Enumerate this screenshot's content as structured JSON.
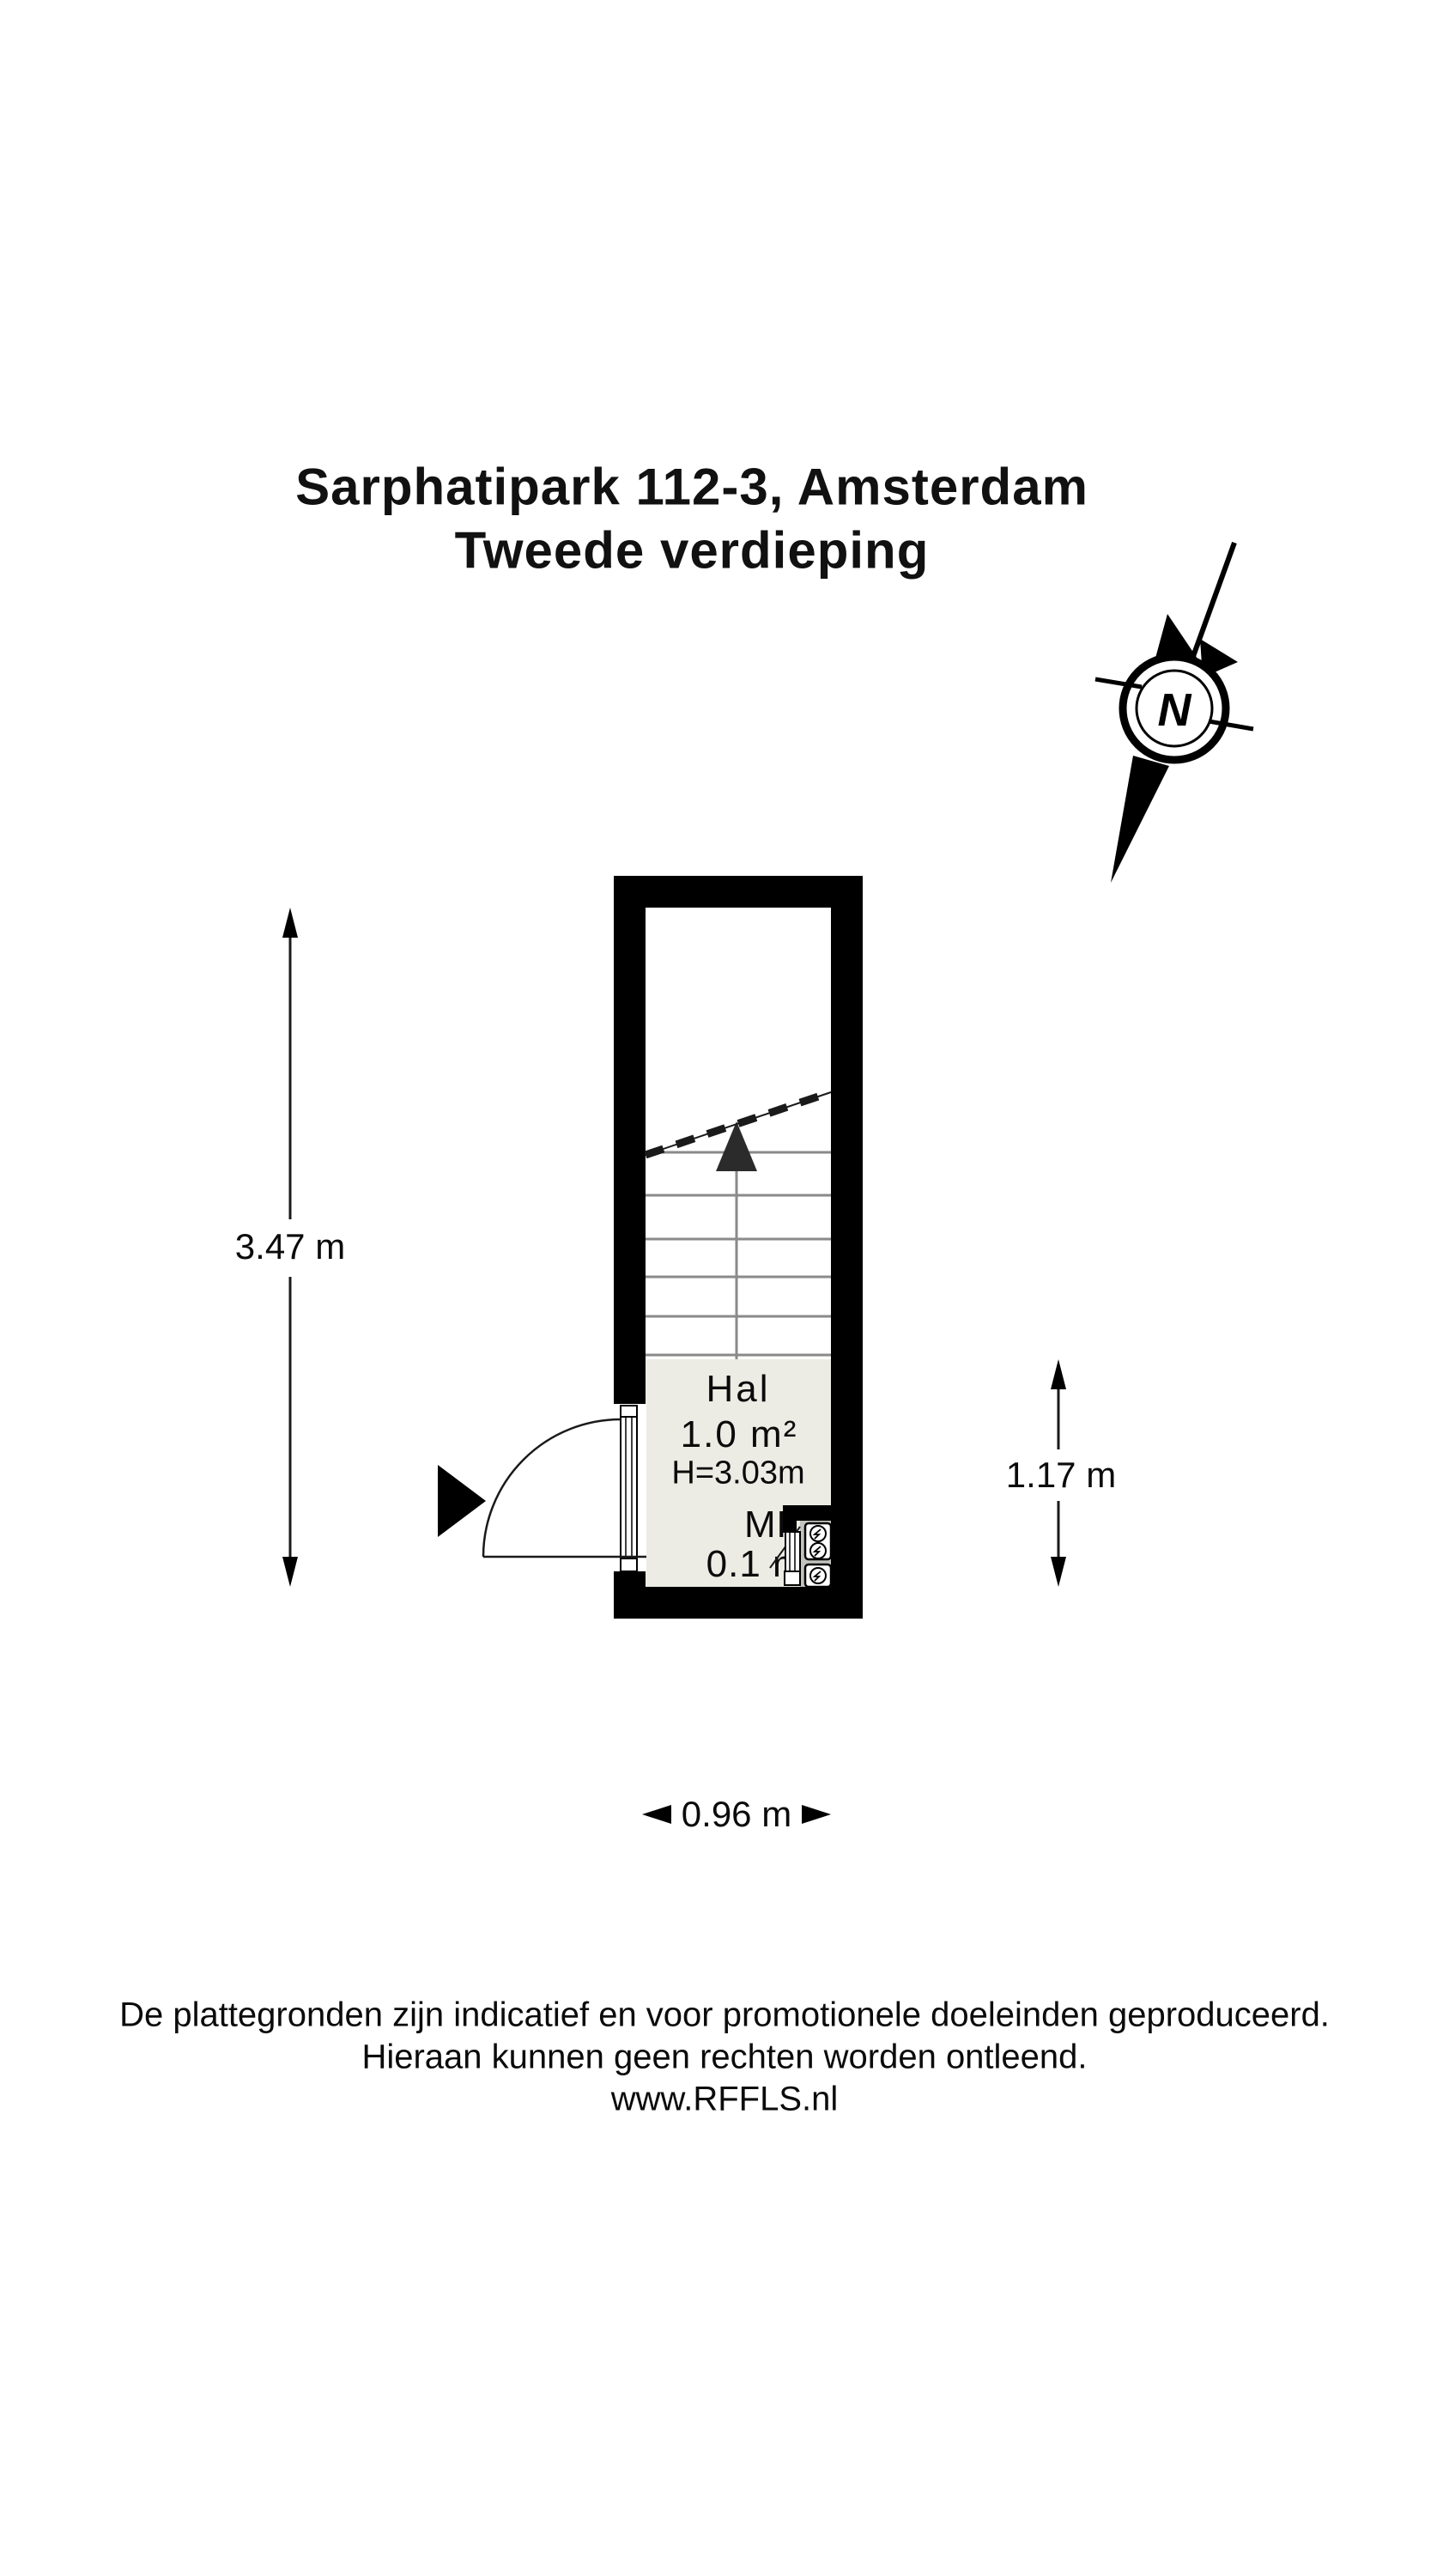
{
  "title": {
    "line1": "Sarphatipark 112-3, Amsterdam",
    "line2": "Tweede verdieping"
  },
  "compass": {
    "label": "N"
  },
  "plan": {
    "rooms": [
      {
        "name": "Hal",
        "area": "1.0 m²",
        "ceiling_height": "H=3.03m"
      },
      {
        "name": "MK",
        "area": "0.1 m²"
      }
    ],
    "dimensions": {
      "left": "3.47 m",
      "right": "1.17 m",
      "bottom": "0.96 m"
    }
  },
  "footer": {
    "line1": "De plattegronden zijn indicatief en voor promotionele doeleinden geproduceerd.",
    "line2": "Hieraan kunnen geen rechten worden ontleend.",
    "line3": "www.RFFLS.nl"
  },
  "colors": {
    "wall": "#000000",
    "hal_floor": "#ECECE4",
    "closet_floor": "#C2C2BE",
    "tread": "#8A8A8A"
  }
}
